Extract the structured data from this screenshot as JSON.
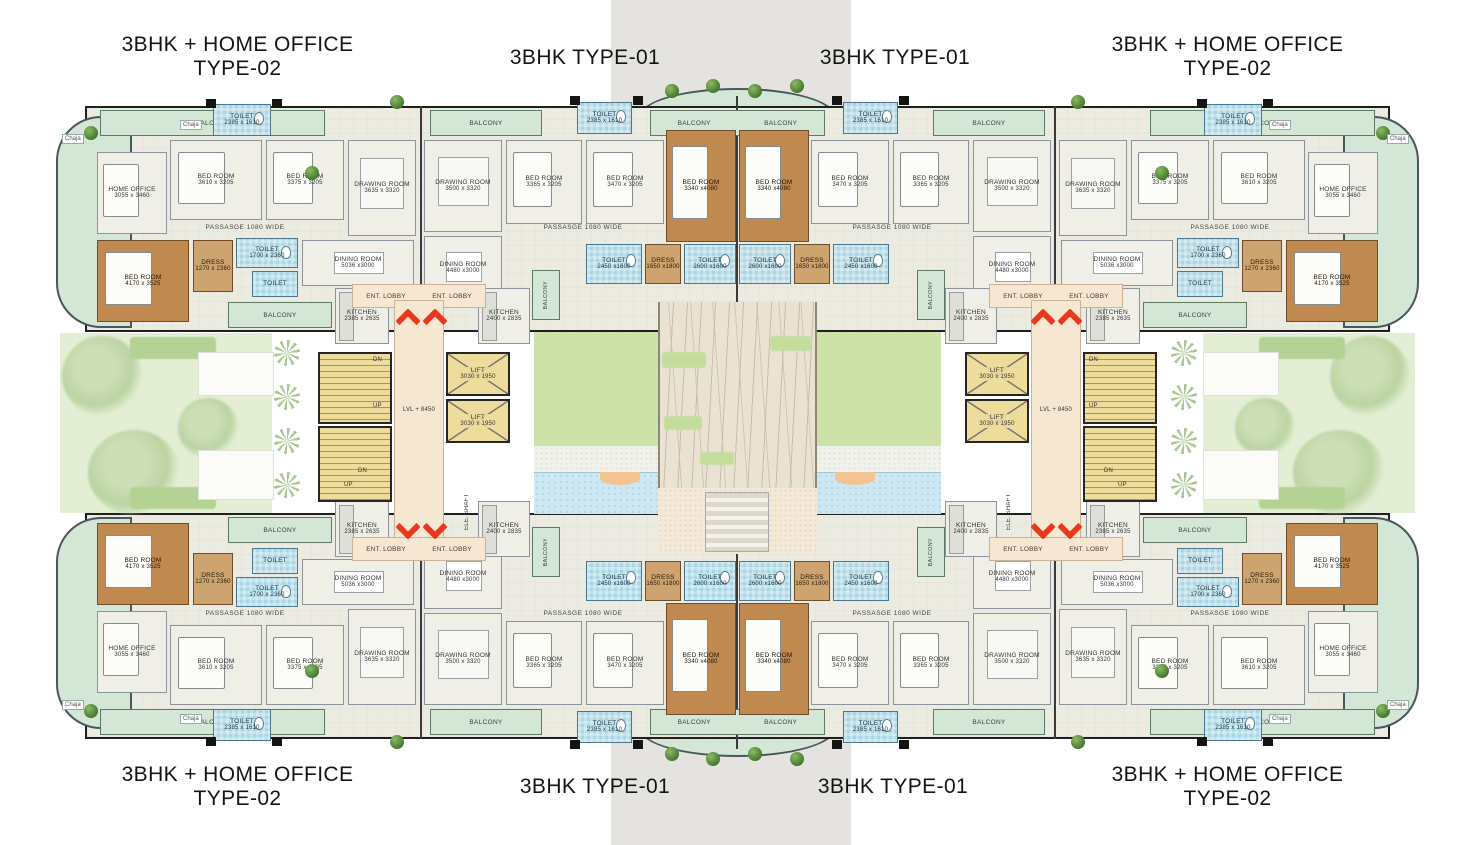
{
  "titles": {
    "type02_line1": "3BHK + HOME OFFICE",
    "type02_line2": "TYPE-02",
    "type01": "3BHK TYPE-01"
  },
  "rooms": {
    "t2": {
      "home_office": {
        "name": "HOME OFFICE",
        "dims": "3055 x 3460"
      },
      "bed1": {
        "name": "BED ROOM",
        "dims": "3610 x 3205"
      },
      "bed2": {
        "name": "BED ROOM",
        "dims": "3375 x 3205"
      },
      "bed3": {
        "name": "BED ROOM",
        "dims": "4170 x 3525"
      },
      "drawing": {
        "name": "DRAWING ROOM",
        "dims": "3635 x 3320"
      },
      "dining": {
        "name": "DINING ROOM",
        "dims": "5036 x3000"
      },
      "kitchen": {
        "name": "KITCHEN",
        "dims": "2385 x 2635"
      },
      "dress": {
        "name": "DRESS",
        "dims": "1270 x 2360"
      },
      "toilet": {
        "name": "TOILET",
        "dims": "1700 x 2360"
      },
      "toilet_entry": {
        "name": "TOILET",
        "dims": "2385 x 1610"
      }
    },
    "t1": {
      "bed1": {
        "name": "BED ROOM",
        "dims": "3365 x 3205"
      },
      "bed2": {
        "name": "BED ROOM",
        "dims": "3470 x 3205"
      },
      "master": {
        "name": "BED ROOM",
        "dims": "3340 x4080"
      },
      "drawing": {
        "name": "DRAWING ROOM",
        "dims": "3500 x 3320"
      },
      "dining": {
        "name": "DINING ROOM",
        "dims": "4480 x3000"
      },
      "kitchen": {
        "name": "KITCHEN",
        "dims": "2400 x 2835"
      },
      "dress": {
        "name": "DRESS",
        "dims": "1650 x1800"
      },
      "toilet1": {
        "name": "TOILET",
        "dims": "2450 x1600"
      },
      "toilet2": {
        "name": "TOILET",
        "dims": "2600 x1600"
      },
      "toilet_entry": {
        "name": "TOILET",
        "dims": "2385 x 1610"
      }
    }
  },
  "core": {
    "ent_lobby": "ENT. LOBBY",
    "lift_name": "LIFT",
    "lift_dims": "3030 x 1950",
    "level": "LVL + 8450",
    "dn": "DN",
    "up": "UP",
    "ele_shaft": "ELE. SHAFT"
  },
  "labels": {
    "balcony": "BALCONY",
    "chaja": "Chaja",
    "passage": "PASSASGE 1080 WIDE"
  },
  "colors": {
    "wood_floor": "#c0894f",
    "toilet_tile": "#a9d6e2",
    "stair_yellow": "#eedc9d",
    "lawn_green": "#cde2a8",
    "balcony_green": "#d4e6d6",
    "lobby_peach": "#f6e7d3",
    "arrow_red": "#e8391d",
    "wall_black": "#1f1f1f",
    "center_band": "#e4e3df"
  }
}
